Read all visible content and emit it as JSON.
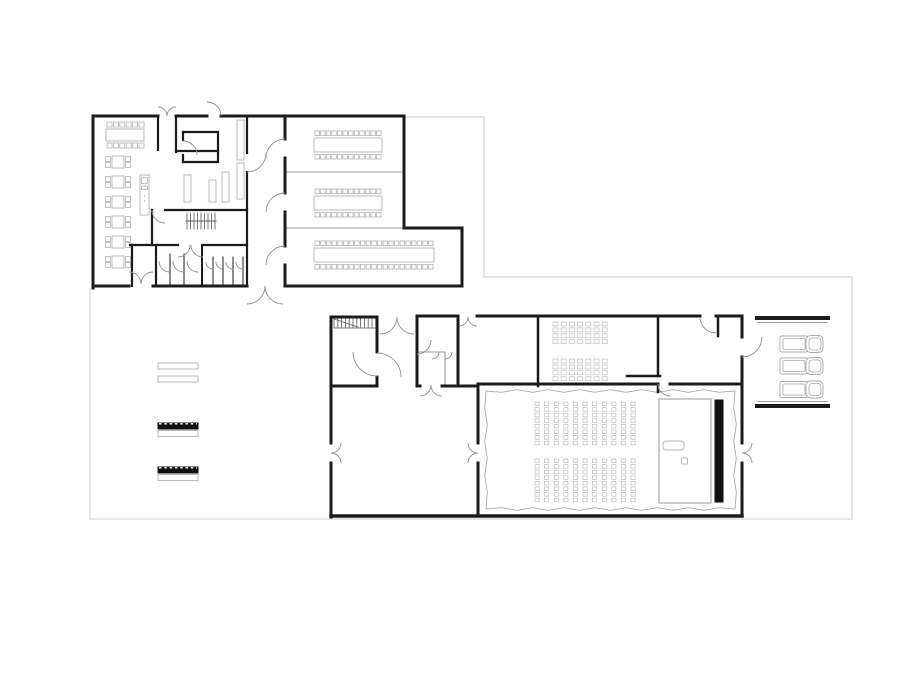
{
  "canvas": {
    "width": 920,
    "height": 690,
    "background": "#ffffff"
  },
  "colors": {
    "wall": "#1b1b1b",
    "thin": "#9a9a9a",
    "site": "#cfcfcf",
    "furniture": "#b3b3b3",
    "seat": "#bdbdbd",
    "stair": "#5a5a5a",
    "door": "#8f8f8f",
    "screen": "#111111",
    "white": "#ffffff"
  },
  "site_outline": [
    [
      406,
      117,
      484,
      117
    ],
    [
      484,
      117,
      484,
      277
    ],
    [
      484,
      277,
      852,
      277
    ],
    [
      852,
      277,
      852,
      519
    ],
    [
      852,
      519,
      90,
      519
    ],
    [
      90,
      519,
      90,
      288
    ]
  ],
  "walls": [
    [
      93,
      116,
      158,
      116,
      3
    ],
    [
      176,
      116,
      207,
      116,
      3
    ],
    [
      221,
      116,
      404,
      116,
      3
    ],
    [
      404,
      116,
      404,
      228,
      3
    ],
    [
      404,
      228,
      462,
      228,
      3
    ],
    [
      462,
      228,
      462,
      286,
      3
    ],
    [
      462,
      286,
      285,
      286,
      3
    ],
    [
      285,
      116,
      285,
      139,
      3
    ],
    [
      285,
      158,
      285,
      193,
      3
    ],
    [
      285,
      212,
      285,
      246,
      3
    ],
    [
      285,
      265,
      285,
      286,
      3
    ],
    [
      93,
      116,
      93,
      288,
      3
    ],
    [
      93,
      286,
      129,
      286,
      3
    ],
    [
      153,
      286,
      247,
      286,
      3
    ],
    [
      158,
      116,
      158,
      150,
      2.2
    ],
    [
      176,
      116,
      176,
      152,
      2.2
    ],
    [
      176,
      151,
      218,
      151,
      2.2
    ],
    [
      183,
      132,
      218,
      132,
      2.2
    ],
    [
      218,
      132,
      218,
      162,
      2.2
    ],
    [
      183,
      162,
      218,
      162,
      2.2
    ],
    [
      183,
      132,
      183,
      140,
      2.2
    ],
    [
      183,
      155,
      183,
      162,
      2.2
    ],
    [
      247,
      116,
      247,
      153,
      2.2
    ],
    [
      247,
      172,
      247,
      286,
      2.2
    ],
    [
      165,
      210,
      247,
      210,
      2.2
    ],
    [
      152,
      210,
      152,
      245,
      2.2
    ],
    [
      130,
      245,
      178,
      245,
      2.2
    ],
    [
      203,
      245,
      247,
      245,
      2.2
    ],
    [
      132,
      245,
      132,
      286,
      2.2
    ],
    [
      156,
      245,
      156,
      286,
      2.2
    ],
    [
      202,
      245,
      202,
      286,
      2
    ],
    [
      170,
      254,
      170,
      286,
      1
    ],
    [
      184,
      254,
      184,
      286,
      1
    ],
    [
      213,
      257,
      213,
      286,
      1
    ],
    [
      223,
      257,
      223,
      286,
      1
    ],
    [
      233,
      257,
      233,
      286,
      1
    ],
    [
      243,
      257,
      243,
      286,
      1
    ],
    [
      331,
      317,
      377,
      317,
      3
    ],
    [
      331,
      317,
      331,
      443,
      3
    ],
    [
      331,
      463,
      331,
      517,
      3
    ],
    [
      331,
      516,
      742,
      516,
      3.5
    ],
    [
      377,
      317,
      377,
      352,
      3
    ],
    [
      377,
      377,
      377,
      386,
      3
    ],
    [
      331,
      386,
      377,
      386,
      3
    ],
    [
      417,
      316,
      458,
      316,
      3
    ],
    [
      417,
      316,
      417,
      386,
      3
    ],
    [
      458,
      316,
      458,
      386,
      3
    ],
    [
      417,
      386,
      420,
      386,
      3
    ],
    [
      442,
      386,
      458,
      386,
      3
    ],
    [
      477,
      316,
      700,
      316,
      3
    ],
    [
      716,
      316,
      742,
      316,
      3
    ],
    [
      742,
      316,
      742,
      337,
      3
    ],
    [
      742,
      357,
      742,
      443,
      3
    ],
    [
      742,
      463,
      742,
      516,
      3
    ],
    [
      538,
      316,
      538,
      386,
      2.5
    ],
    [
      658,
      316,
      658,
      376,
      2.5
    ],
    [
      627,
      376,
      660,
      376,
      2.5
    ],
    [
      718,
      316,
      718,
      336,
      2.5
    ],
    [
      478,
      384,
      658,
      384,
      3
    ],
    [
      670,
      384,
      742,
      384,
      3
    ],
    [
      658,
      384,
      658,
      392,
      2.5
    ],
    [
      458,
      386,
      478,
      386,
      3
    ],
    [
      478,
      384,
      478,
      443,
      3
    ],
    [
      478,
      463,
      478,
      516,
      3
    ],
    [
      757,
      318,
      828,
      318,
      4
    ],
    [
      757,
      406,
      828,
      406,
      4
    ]
  ],
  "thin_lines": [
    [
      285,
      172,
      404,
      172
    ],
    [
      285,
      228,
      404,
      228
    ],
    [
      758,
      322.5,
      827,
      322.5
    ],
    [
      758,
      401.5,
      827,
      401.5
    ],
    [
      417,
      352,
      445,
      352
    ],
    [
      445,
      352,
      445,
      386
    ]
  ],
  "doors": [
    [
      158,
      116,
      9,
      270,
      360
    ],
    [
      176,
      116,
      9,
      180,
      270
    ],
    [
      207,
      116,
      14,
      270,
      360
    ],
    [
      247,
      153,
      19,
      0,
      90
    ],
    [
      285,
      158,
      19,
      180,
      270
    ],
    [
      285,
      212,
      19,
      180,
      270
    ],
    [
      285,
      265,
      19,
      180,
      270
    ],
    [
      129,
      284,
      12,
      270,
      360
    ],
    [
      153,
      284,
      12,
      180,
      270
    ],
    [
      247,
      286,
      18,
      0,
      90
    ],
    [
      283,
      286,
      18,
      90,
      180
    ],
    [
      178,
      245,
      12,
      0,
      90
    ],
    [
      203,
      245,
      12,
      90,
      180
    ],
    [
      170,
      261,
      11,
      90,
      180
    ],
    [
      184,
      261,
      11,
      90,
      180
    ],
    [
      198,
      261,
      11,
      90,
      180
    ],
    [
      213,
      262,
      7,
      90,
      180
    ],
    [
      223,
      262,
      7,
      90,
      180
    ],
    [
      233,
      262,
      7,
      90,
      180
    ],
    [
      243,
      262,
      7,
      90,
      180
    ],
    [
      165,
      210,
      13,
      90,
      180
    ],
    [
      183,
      155,
      14,
      270,
      360
    ],
    [
      380,
      317,
      17,
      0,
      90
    ],
    [
      414,
      317,
      17,
      90,
      180
    ],
    [
      377,
      352,
      24,
      90,
      180
    ],
    [
      377,
      377,
      24,
      270,
      360
    ],
    [
      420,
      385,
      11,
      0,
      90
    ],
    [
      442,
      385,
      11,
      90,
      180
    ],
    [
      459,
      317,
      9,
      0,
      90
    ],
    [
      477,
      317,
      9,
      90,
      180
    ],
    [
      716,
      317,
      16,
      90,
      180
    ],
    [
      742,
      337,
      20,
      0,
      90
    ],
    [
      331,
      443,
      10,
      0,
      90
    ],
    [
      331,
      463,
      10,
      270,
      360
    ],
    [
      478,
      443,
      10,
      90,
      180
    ],
    [
      478,
      463,
      10,
      180,
      270
    ],
    [
      742,
      443,
      10,
      0,
      90
    ],
    [
      742,
      463,
      10,
      270,
      360
    ],
    [
      670,
      384,
      12,
      90,
      180
    ],
    [
      417,
      340,
      14,
      0,
      90
    ],
    [
      432,
      352,
      7,
      0,
      90
    ],
    [
      445,
      352,
      7,
      0,
      90
    ]
  ],
  "stairs": {
    "upper": {
      "x0": 187,
      "x1": 215,
      "y0": 213,
      "y1": 229,
      "step": 3.5,
      "divider": [
        186,
        221,
        216,
        221
      ]
    },
    "lower": {
      "x0": 334,
      "x1": 376,
      "y0": 318,
      "y1": 328,
      "step": 3.8,
      "diagonal": [
        334,
        319,
        358,
        327
      ],
      "base": [
        334,
        328,
        376,
        328
      ]
    }
  },
  "dining": {
    "long_table": {
      "x": 106,
      "y": 129,
      "w": 38,
      "h": 12
    },
    "long_chairs": {
      "count": 6,
      "x0": 107,
      "step": 6.4,
      "size": 5,
      "y_top": 122,
      "y_bottom": 143
    },
    "small_tables": {
      "x": 112,
      "w": 12,
      "h": 12,
      "ys": [
        156,
        176,
        196,
        216,
        236,
        256
      ]
    },
    "small_chairs": {
      "size": 5,
      "left_x": 105.5,
      "right_x": 125.5,
      "dy": [
        0.5,
        6.5
      ]
    },
    "counter": {
      "x": 140,
      "y": 175,
      "w": 9,
      "h": 40,
      "items": [
        [
          141.5,
          177.5,
          6,
          6
        ],
        [
          141.5,
          186,
          6,
          3.5
        ]
      ],
      "dots": [
        [
          144.5,
          196
        ],
        [
          144.5,
          201
        ]
      ]
    }
  },
  "shelves": [
    [
      237,
      120,
      7,
      40
    ],
    [
      237,
      163,
      7,
      36
    ],
    [
      222,
      172,
      7,
      30
    ],
    [
      209,
      180,
      7,
      22
    ],
    [
      184,
      175,
      7,
      27
    ]
  ],
  "chair_size": 4.5,
  "seminar_tables": [
    {
      "x": 314,
      "y": 138,
      "w": 68,
      "h": 14,
      "chairs": 12,
      "chair_y_top": 131,
      "chair_y_bottom": 154.5
    },
    {
      "x": 314,
      "y": 196,
      "w": 68,
      "h": 14,
      "chairs": 12,
      "chair_y_top": 189,
      "chair_y_bottom": 212.5
    },
    {
      "x": 314,
      "y": 248,
      "w": 120,
      "h": 14,
      "chairs": 21,
      "chair_y_top": 241,
      "chair_y_bottom": 264.5
    }
  ],
  "classroom_desks": {
    "x0": 553,
    "cols": 7,
    "step_x": 8.2,
    "rows": 4,
    "step_y": 5.9,
    "w": 5,
    "h": 4,
    "group_ys": [
      322,
      359
    ]
  },
  "auditorium_seats": {
    "x0": 535,
    "cols": 11,
    "step_x": 9.6,
    "rows": 8,
    "step_y": 5.6,
    "w": 4.2,
    "h": 3.6,
    "block_ys": [
      402,
      459
    ]
  },
  "curtain": {
    "x0": 486,
    "y0": 391,
    "x1": 735,
    "y1": 509,
    "amplitude": 1.3,
    "segment": 16
  },
  "stage": {
    "platform": [
      659,
      399,
      52,
      104
    ],
    "screen": [
      715,
      400,
      8,
      102
    ],
    "podium": [
      663,
      441,
      21,
      9
    ],
    "box": [
      681.5,
      458,
      6,
      6
    ]
  },
  "benches": {
    "rails": [
      [
        158,
        363,
        40,
        6
      ],
      [
        158,
        376,
        40,
        6
      ]
    ],
    "black_bars": [
      [
        158,
        423,
        40,
        6
      ],
      [
        158,
        467,
        40,
        6
      ]
    ],
    "underlays": [
      [
        158,
        430.5,
        40,
        6
      ],
      [
        158,
        474.5,
        40,
        6
      ]
    ]
  },
  "garage": {
    "cars_x": 780,
    "car_ys": [
      344,
      366,
      389.5
    ]
  }
}
